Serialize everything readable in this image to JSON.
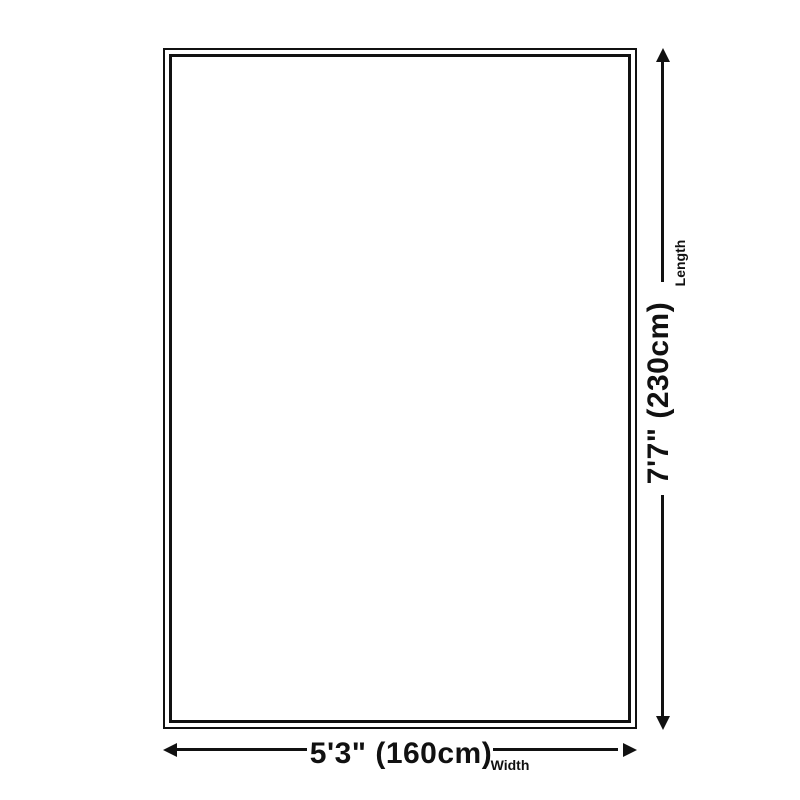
{
  "diagram": {
    "type": "rug-size-dimension-diagram",
    "background_color": "#ffffff",
    "line_color": "#111111",
    "rug": {
      "shape": "rectangle-double-outline"
    },
    "length": {
      "label": "Length",
      "value": "7'7\" (230cm)"
    },
    "width": {
      "label": "Width",
      "value": "5'3\" (160cm)"
    }
  }
}
